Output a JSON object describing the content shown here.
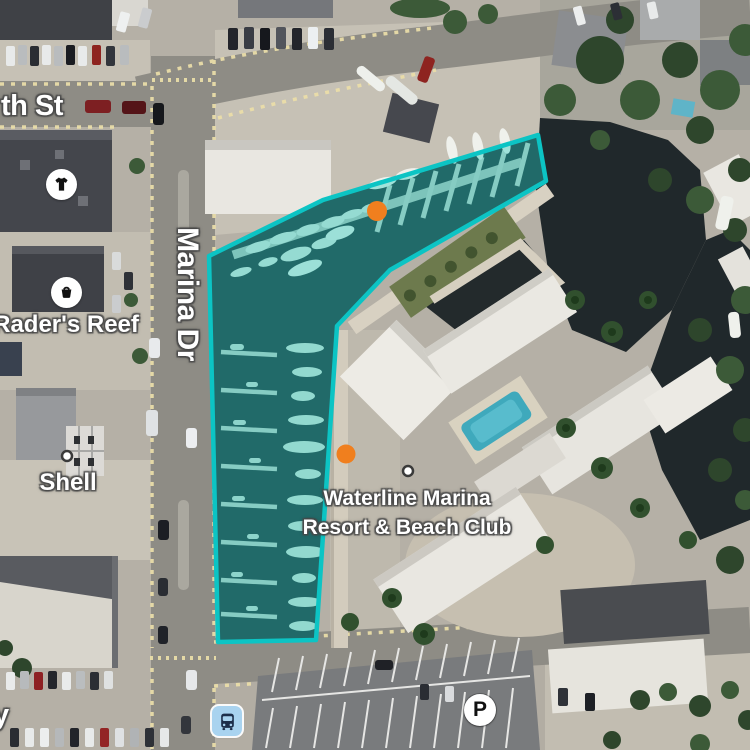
{
  "map": {
    "street_labels": {
      "partial_top": "th St",
      "marina_dr": "Marina Dr",
      "partial_bottom": "y"
    },
    "pois": {
      "raders_reef": "Rader's Reef",
      "shell": "Shell",
      "waterline_line1": "Waterline Marina",
      "waterline_line2": "Resort & Beach Club",
      "parking_glyph": "P"
    },
    "icons": {
      "clothing_store": "tshirt-icon",
      "shopping": "basket-icon",
      "transit": "bus-icon",
      "parking": "parking-icon"
    },
    "selection": {
      "fill_rgba": "rgba(14,198,186,0.35)",
      "stroke_color": "#0cc4c4"
    },
    "markers": {
      "orange_hex": "#f07f1e",
      "orange_count": 2,
      "white_dot_hex": "#ffffff"
    }
  }
}
